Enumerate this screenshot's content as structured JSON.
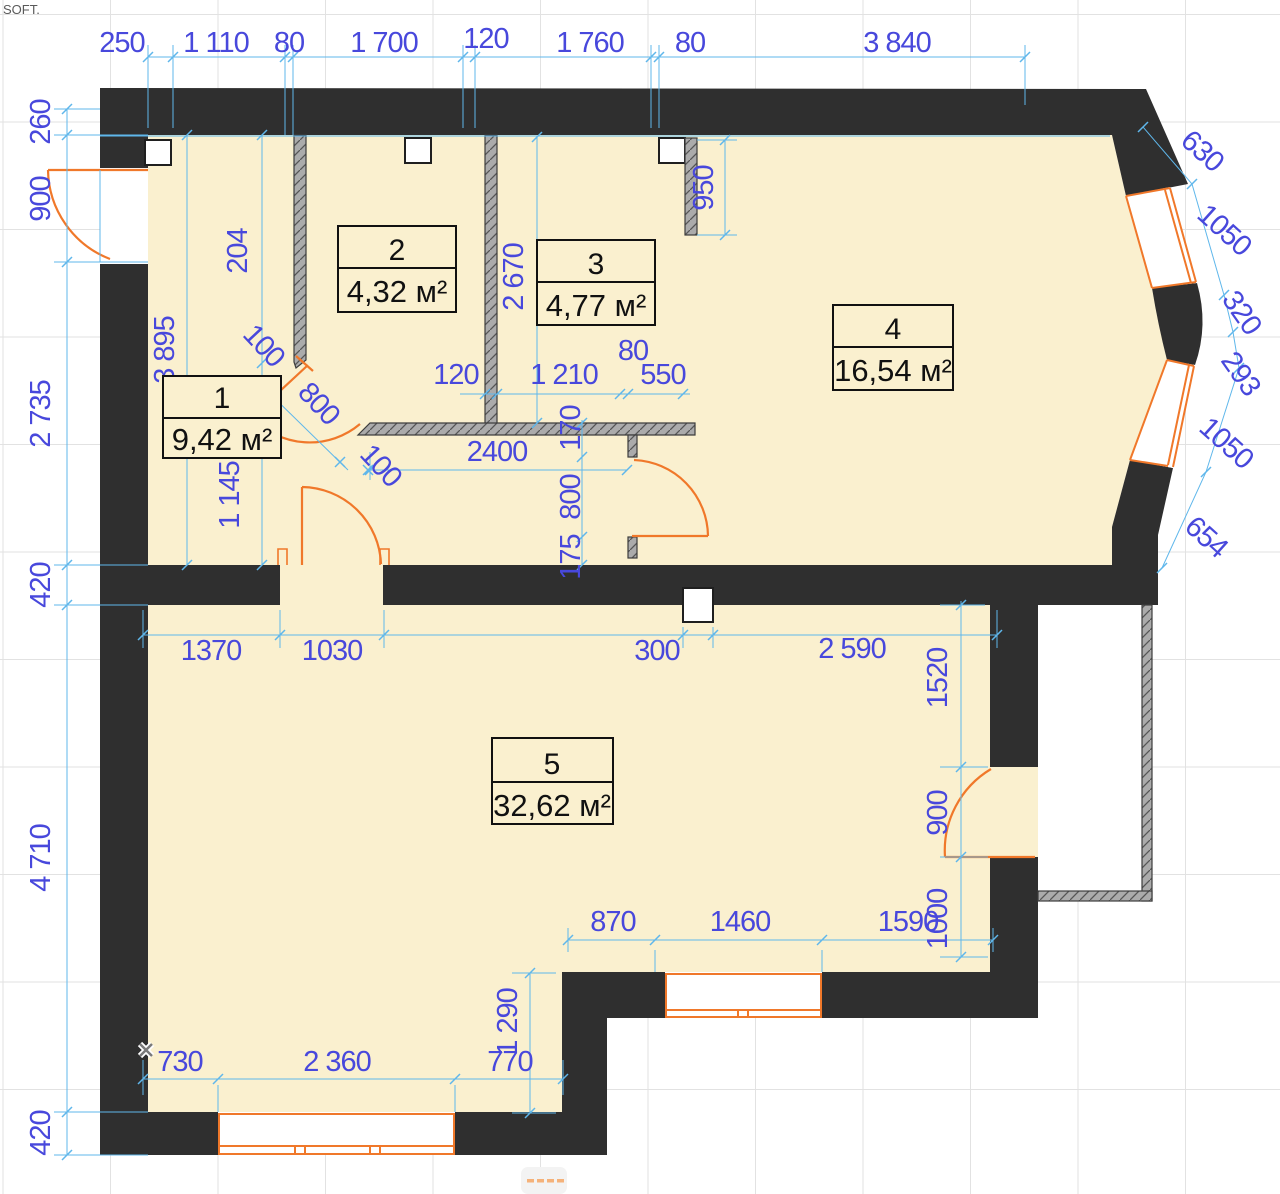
{
  "watermark": "SOFT.",
  "canvas": {
    "rooms": [
      {
        "number": "1",
        "area": "9,42 м²"
      },
      {
        "number": "2",
        "area": "4,32 м²"
      },
      {
        "number": "3",
        "area": "4,77 м²"
      },
      {
        "number": "4",
        "area": "16,54 м²"
      },
      {
        "number": "5",
        "area": "32,62 м²"
      }
    ],
    "dims": {
      "top_250": "250",
      "top_1110": "1 110",
      "top_80a": "80",
      "top_1700": "1 700",
      "top_120": "120",
      "top_1760": "1 760",
      "top_80b": "80",
      "top_3840": "3 840",
      "left_260": "260",
      "left_900": "900",
      "left_2735": "2 735",
      "left_420a": "420",
      "left_4710": "4 710",
      "left_420b": "420",
      "bay_630": "630",
      "bay_1050a": "1050",
      "bay_320": "320",
      "bay_293": "293",
      "bay_1050b": "1050",
      "bay_654": "654",
      "hall_3895": "3 895",
      "hall_204": "204",
      "hall_1145": "1 145",
      "hall_100a": "100",
      "hall_800": "800",
      "hall_100b": "100",
      "r3_2670": "2 670",
      "r3_950": "950",
      "mid_120": "120",
      "mid_1210": "1 210",
      "mid_80": "80",
      "mid_550": "550",
      "cor_2400": "2400",
      "cor_170": "170",
      "cor_800": "800",
      "cor_175": "175",
      "m2_1370": "1370",
      "m2_1030": "1030",
      "m2_300": "300",
      "m2_2590": "2 590",
      "m2_1520": "1520",
      "rt_900": "900",
      "rt_1000": "1000",
      "b_870": "870",
      "b_1460": "1460",
      "b_1590": "1590",
      "bt_1290": "1 290",
      "bt_730": "730",
      "bt_2360": "2 360",
      "bt_770": "770"
    },
    "colors": {
      "wall": "#2f2f2f",
      "floor": "#faf0cf",
      "dim_text": "#4848dc",
      "dim_line": "#5fb7eb",
      "fixture": "#f0782a",
      "partition": "#ababab",
      "grid": "#e2e2e2"
    }
  }
}
